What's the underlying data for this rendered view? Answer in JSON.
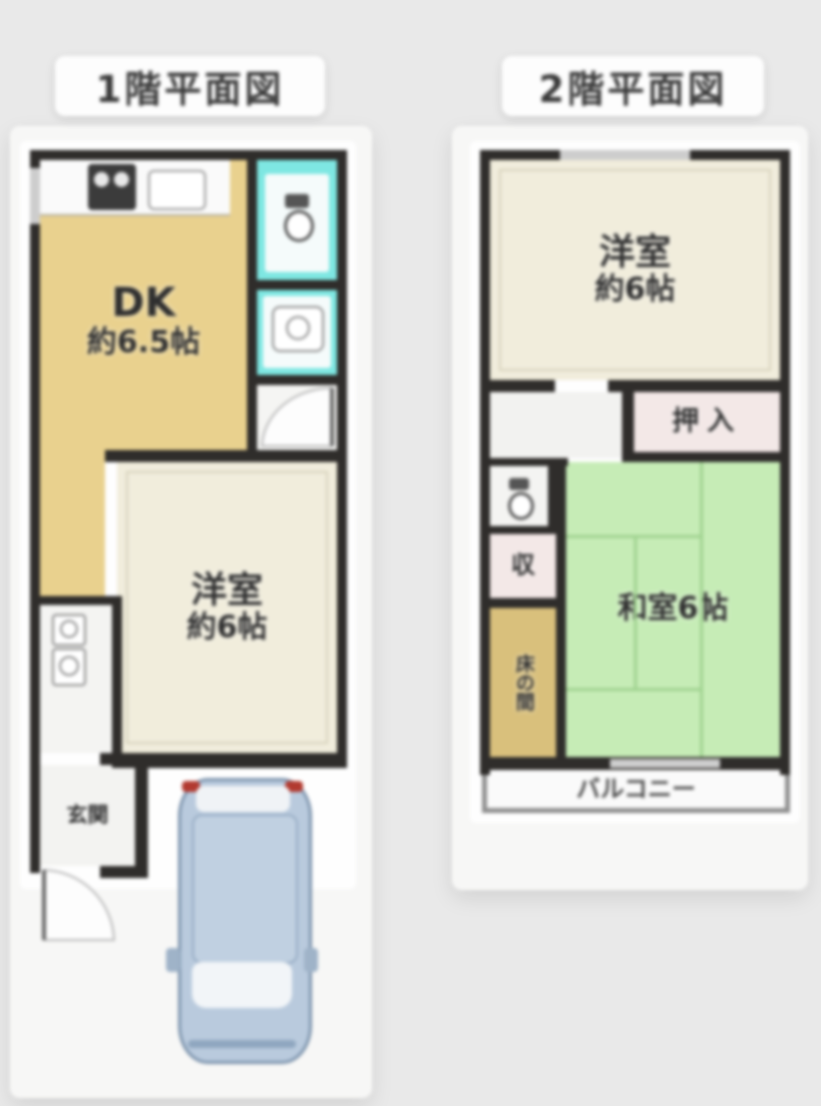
{
  "floor1": {
    "title": "1階平面図",
    "dk_label_1": "DK",
    "dk_label_2": "約6.5帖",
    "western_label_1": "洋室",
    "western_label_2": "約6帖",
    "entrance_label": "玄関"
  },
  "floor2": {
    "title": "2階平面図",
    "western_label_1": "洋室",
    "western_label_2": "約6帖",
    "closet_label": "押入",
    "storage_label": "収",
    "tokonoma_label": "床の間",
    "tatami_label": "和室6帖",
    "balcony_label": "バルコニー"
  },
  "colors": {
    "background": "#e9e9e9",
    "wall": "#2f2d2b",
    "dk_fill": "#e9d18e",
    "western_room_fill": "#f1eddc",
    "tatami_fill": "#c6ecb6",
    "wet_area_fill": "#7ee7e2",
    "closet_fill": "#f3e8e7",
    "tokonoma_fill": "#d9c07c",
    "car_body": "#b9cadd",
    "taillight": "#b23a30"
  }
}
